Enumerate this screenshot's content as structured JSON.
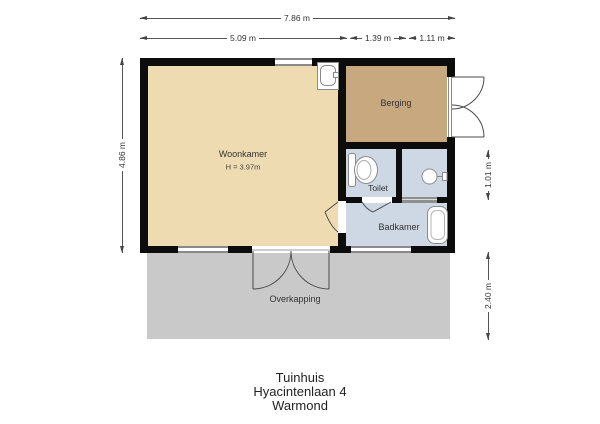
{
  "dimensions": {
    "top_total": "7.86 m",
    "top_seg1": "5.09 m",
    "top_seg2": "1.39 m",
    "top_seg3": "1.11 m",
    "left_height": "4.86 m",
    "right_top": "1.01 m",
    "right_bottom": "2.40 m"
  },
  "rooms": {
    "woonkamer": {
      "label": "Woonkamer",
      "ceiling_height": "H = 3.97m"
    },
    "berging": {
      "label": "Berging"
    },
    "toilet": {
      "label": "Toilet"
    },
    "badkamer": {
      "label": "Badkamer"
    },
    "overkapping": {
      "label": "Overkapping"
    }
  },
  "fixtures": [
    "kitchen-sink",
    "toilet",
    "small-washbasin",
    "washbasin"
  ],
  "title_block": {
    "line1": "Tuinhuis",
    "line2": "Hyacintenlaan 4",
    "line3": "Warmond"
  },
  "colors": {
    "wall": "#0c0c0c",
    "woonkamer_floor": "#eedbb2",
    "berging_floor": "#c8a87e",
    "wet_room_floor": "#cdd8e4",
    "overkapping_floor": "#c9c9c9",
    "window_frame": "#8a8a8a",
    "dimension_line": "#555555"
  }
}
